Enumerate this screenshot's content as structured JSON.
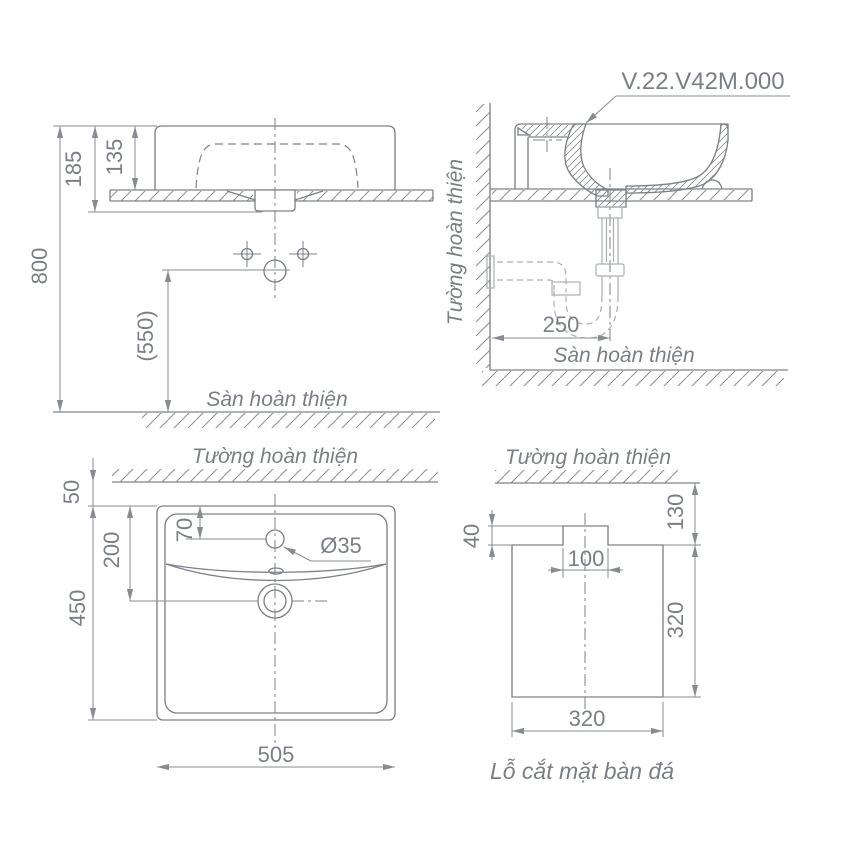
{
  "colors": {
    "line": "#7d828a",
    "dim": "#878c93",
    "text": "#7a7f87",
    "pipe": "#a9afb5",
    "hatch": "#8a8f96",
    "background": "#ffffff"
  },
  "product": {
    "code": "V.22.V42M.000"
  },
  "front_view": {
    "dim_total_height": "800",
    "dim_rim_to_counter_bottom": "185",
    "dim_height_above_counter": "135",
    "dim_drain_outlet_height": "(550)",
    "floor_label": "Sàn hoàn thiện"
  },
  "side_view": {
    "wall_label": "Tường hoàn thiện",
    "floor_label": "Sàn hoàn thiện",
    "dim_drain_to_wall": "250"
  },
  "plan_view": {
    "wall_label": "Tường hoàn thiện",
    "dim_wall_gap": "50",
    "dim_faucet_from_edge": "70",
    "dim_drain_from_edge": "200",
    "dim_depth": "450",
    "dim_width": "505",
    "dim_faucet_hole": "Ø35"
  },
  "cutout_view": {
    "wall_label": "Tường hoàn thiện",
    "dim_notch_depth": "40",
    "dim_wall_offset": "130",
    "dim_notch_width": "100",
    "dim_depth": "320",
    "dim_width": "320",
    "caption": "Lỗ cắt mặt bàn đá"
  }
}
